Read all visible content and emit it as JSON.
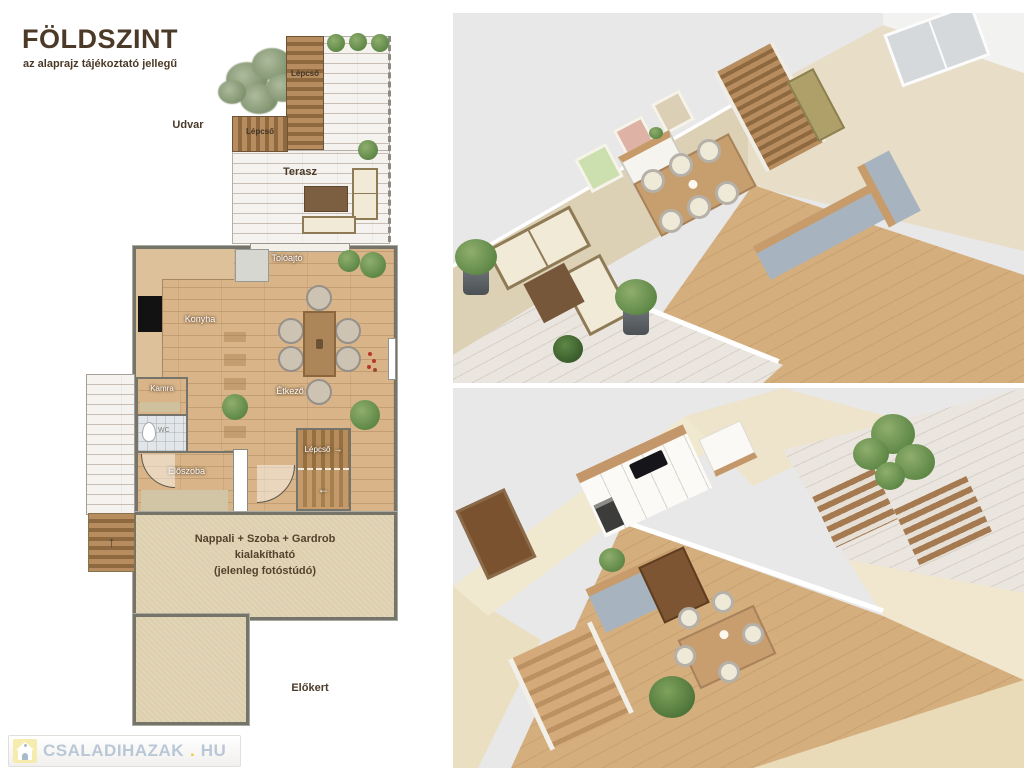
{
  "header": {
    "title": "FÖLDSZINT",
    "subtitle": "az alaprajz tájékoztató jellegű"
  },
  "floorplan": {
    "outdoor": {
      "udvar": "Udvar",
      "terasz": "Terasz",
      "elokert": "Előkert",
      "lepcso_top": "Lépcső",
      "lepcso_side": "Lépcső"
    },
    "rooms": {
      "toloajto": "Tolóajtó",
      "konyha": "Konyha",
      "etkezo": "Étkező",
      "kamra": "Kamra",
      "wc": "WC",
      "eloszoba": "Előszoba",
      "lepcso_inner": "Lépcső"
    },
    "nappali": {
      "line1": "Nappali + Szoba + Gardrob",
      "line2": "kialakítható",
      "line3": "(jelenleg fotóstúdó)"
    },
    "arrows": {
      "right": "→",
      "left": "←",
      "up": "↑"
    }
  },
  "watermark": {
    "name": "CSALADIHAZAK",
    "dot": ".",
    "tld": "HU"
  },
  "colors": {
    "wood_floor": "#d8b488",
    "deck_whitewash": "#e8e2db",
    "stairs_wood": "#a57c50",
    "beige_room": "#ddcfad",
    "wall_outline": "#74746a",
    "render_background": "#e8e8e8",
    "label_dark": "#4a3b2a",
    "watermark_blue": "#bac7d7",
    "watermark_yellow": "#f6ecae"
  }
}
